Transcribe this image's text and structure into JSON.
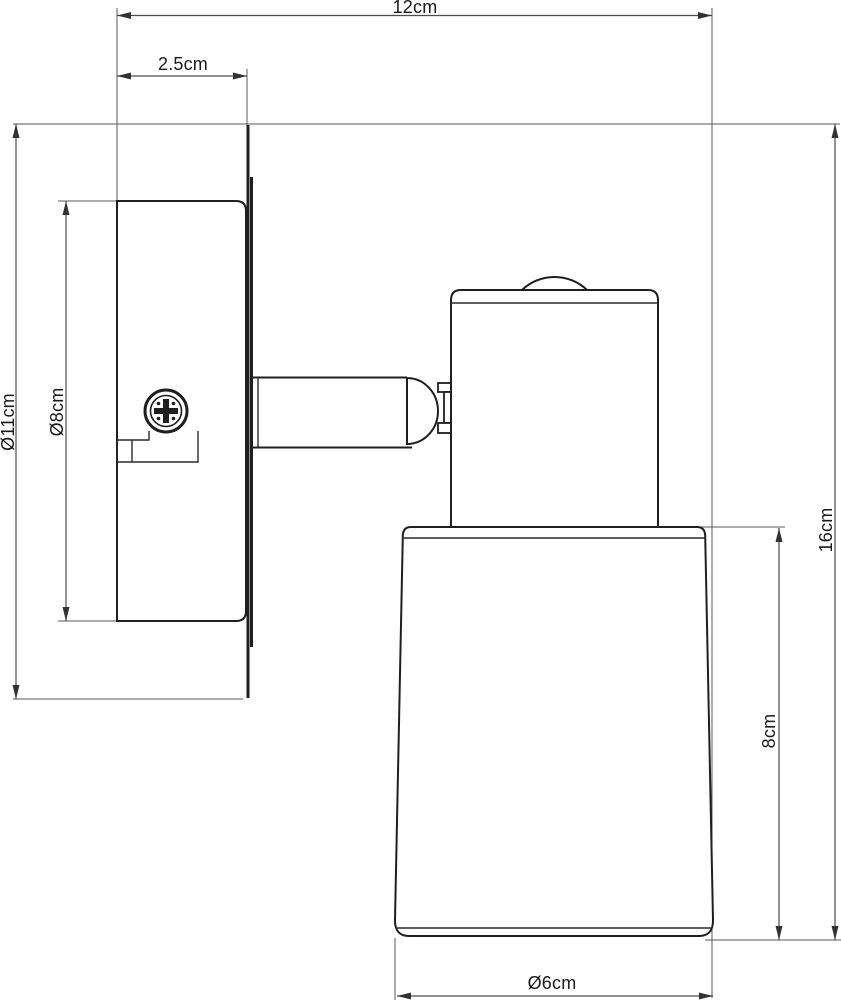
{
  "drawing": {
    "labels": {
      "overall_depth": "12cm",
      "canopy_depth": "2.5cm",
      "backplate_diameter": "Ø11cm",
      "canopy_diameter": "Ø8cm",
      "overall_height": "16cm",
      "shade_height": "8cm",
      "shade_diameter": "Ø6cm"
    },
    "colors": {
      "background": "#ffffff",
      "object_line": "#1f1f1f",
      "dimension_line": "#4d4d4d",
      "text": "#1a1a1a"
    }
  }
}
